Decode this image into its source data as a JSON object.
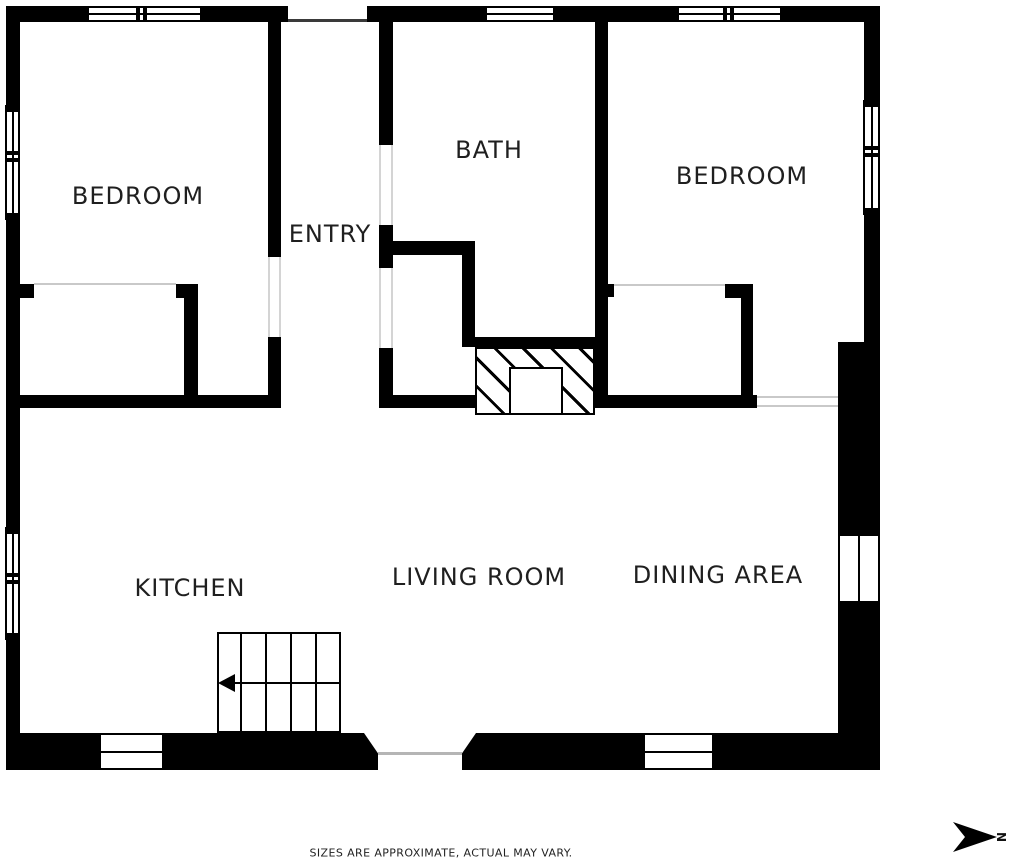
{
  "rooms": {
    "bedroom_left": "BEDROOM",
    "bath": "BATH",
    "bedroom_right": "BEDROOM",
    "entry": "ENTRY",
    "kitchen": "KITCHEN",
    "living_room": "LIVING ROOM",
    "dining_area": "DINING AREA"
  },
  "disclaimer": "SIZES ARE APPROXIMATE, ACTUAL MAY VARY.",
  "compass": {
    "north_label": "N",
    "direction": "right"
  },
  "colors": {
    "wall": "#000000",
    "background": "#ffffff",
    "label_text": "#1f1f1f",
    "thin_line": "#c9c9c9"
  }
}
